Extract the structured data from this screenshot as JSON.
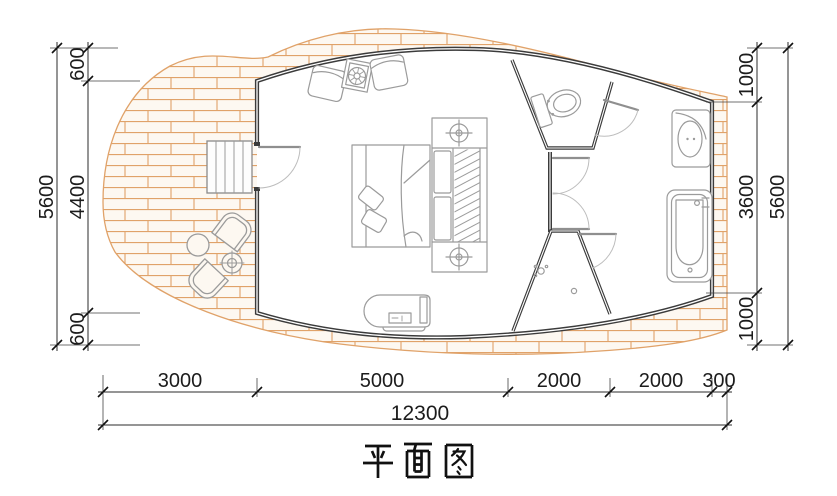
{
  "title": "平面图",
  "dimensions": {
    "left": {
      "segments": [
        "600",
        "4400",
        "600"
      ],
      "total": "5600"
    },
    "right": {
      "segments": [
        "1000",
        "3600",
        "1000"
      ],
      "total": "5600"
    },
    "bottom": {
      "segments": [
        "3000",
        "5000",
        "2000",
        "2000",
        "300"
      ],
      "total": "12300"
    }
  },
  "colors": {
    "deck_line": "#e0a269",
    "deck_fill": "#fdf8f1",
    "wall": "#3b3b3b",
    "furniture_line": "#9b9b9b",
    "dimension_line": "#2b2b2b",
    "text": "#1c1c1c"
  },
  "fixtures": [
    "wood-deck",
    "entry-stairs",
    "entry-door",
    "armchair",
    "coffee-table",
    "double-bed",
    "pillow",
    "wardrobe",
    "bedside-lamp",
    "tv-cabinet",
    "interior-door",
    "toilet",
    "shower",
    "floor-drain",
    "washbasin",
    "bathtub",
    "outdoor-chair",
    "outdoor-table",
    "potted-plant"
  ]
}
